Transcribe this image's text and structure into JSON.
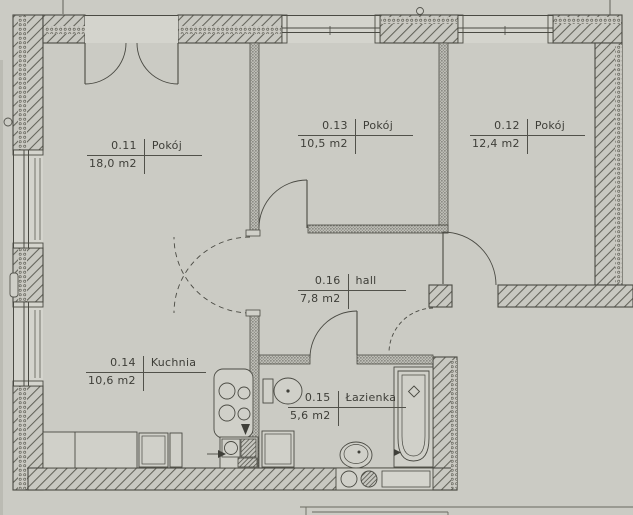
{
  "palette": {
    "paper": "#cbcbc4",
    "ink": "#4a4a43",
    "fixture_fill": "#d0d0c9",
    "label_line": "#51514a"
  },
  "rooms": [
    {
      "number": "0.11",
      "name": "Pokój",
      "area": "18,0 m2"
    },
    {
      "number": "0.13",
      "name": "Pokój",
      "area": "10,5 m2"
    },
    {
      "number": "0.12",
      "name": "Pokój",
      "area": "12,4 m2"
    },
    {
      "number": "0.16",
      "name": "hall",
      "area": "7,8 m2"
    },
    {
      "number": "0.14",
      "name": "Kuchnia",
      "area": "10,6 m2"
    },
    {
      "number": "0.15",
      "name": "Łazienka",
      "area": "5,6 m2"
    }
  ]
}
